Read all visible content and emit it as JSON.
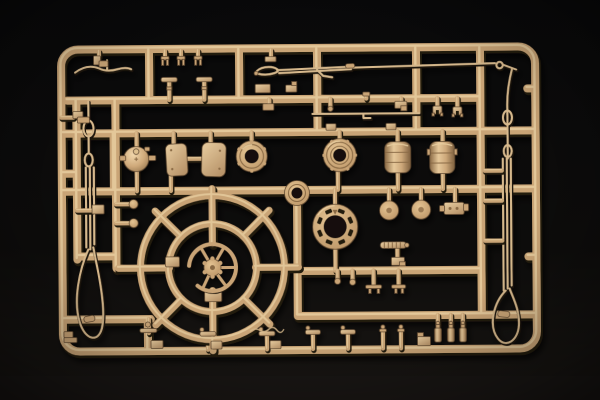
{
  "scene": {
    "type": "photograph",
    "alt": "Tan plastic model-kit sprue (runner frame full of molded parts) photographed on a black background",
    "subject": "injection-molded model kit parts sprue",
    "backdrop": "dark studio surface"
  },
  "colors": {
    "background": "#0a0a0b",
    "backdrop-low": "#1b1815",
    "plastic": "#c9a476",
    "plastic-light": "#ead0a2",
    "plastic-dark": "#8a6a45",
    "plastic-edge": "#241a10",
    "cable": "#d6b88c",
    "hole": "#17110a"
  },
  "sprue": {
    "frame": "rounded rectangular runner frame with internal runner grid",
    "parts": [
      {
        "name": "turret-ring-wheel",
        "label": "large eight-spoke circular turret ring",
        "location": "lower left-center"
      },
      {
        "name": "hub-wheel",
        "label": "small spoked hub with partial rim",
        "location": "center of turret ring"
      },
      {
        "name": "dome-part",
        "label": "round dome with side lugs",
        "location": "middle row, left"
      },
      {
        "name": "hatch-plates",
        "label": "pair of rounded hatch covers",
        "count": 2,
        "location": "middle row"
      },
      {
        "name": "cupola-ring",
        "label": "round cupola with open center",
        "location": "middle row"
      },
      {
        "name": "ringed-cylinder",
        "label": "ribbed cylinder with open center",
        "location": "middle row, center"
      },
      {
        "name": "stowage-drums",
        "label": "two cylindrical stowage drums",
        "count": 2,
        "location": "middle row, right"
      },
      {
        "name": "perforated-ring",
        "label": "flanged ring with eight slots",
        "location": "center, below middle row"
      },
      {
        "name": "small-discs",
        "label": "two small round discs",
        "count": 2,
        "location": "right of perforated ring"
      },
      {
        "name": "equipment-box",
        "label": "small detailed box fitting",
        "location": "right-center"
      },
      {
        "name": "ribbed-rod",
        "label": "short ribbed rod with bracket",
        "location": "right-center"
      },
      {
        "name": "junction-washer",
        "label": "washer molded at runner junction",
        "location": "center"
      },
      {
        "name": "tow-cable-left",
        "label": "long looped tow cable with eyelets and ferrule",
        "location": "left edge"
      },
      {
        "name": "tow-cable-right",
        "label": "long looped tow cable with eyelets and ferrule",
        "location": "right edge"
      },
      {
        "name": "antenna-rods",
        "label": "two long thin antenna rods",
        "count": 2,
        "location": "upper area"
      },
      {
        "name": "wavy-rod",
        "label": "thin wavy rod",
        "location": "upper left"
      },
      {
        "name": "clevis-forks",
        "label": "three small fork fittings",
        "count": 3,
        "location": "top edge"
      },
      {
        "name": "t-posts",
        "label": "two T-shaped posts",
        "count": 2,
        "location": "upper left"
      },
      {
        "name": "spring-clips",
        "label": "two small clips",
        "count": 2,
        "location": "upper right"
      },
      {
        "name": "periscope-posts",
        "label": "row of small T-shaped fittings with base boxes",
        "location": "along bottom rail"
      },
      {
        "name": "pins-and-bottles",
        "label": "small pins and bottle-shaped fittings",
        "location": "bottom right"
      },
      {
        "name": "hanging-pins",
        "label": "small pins and cross rods",
        "location": "below center-right runner"
      },
      {
        "name": "rod-ball-pins",
        "label": "two rods with ball ends",
        "count": 2,
        "location": "mid left"
      },
      {
        "name": "small-brackets",
        "label": "assorted small boxes and brackets",
        "location": "scattered"
      },
      {
        "name": "engraved-squiggle",
        "label": "thin engraved scribble marking",
        "location": "above bottom rail, center"
      }
    ]
  }
}
